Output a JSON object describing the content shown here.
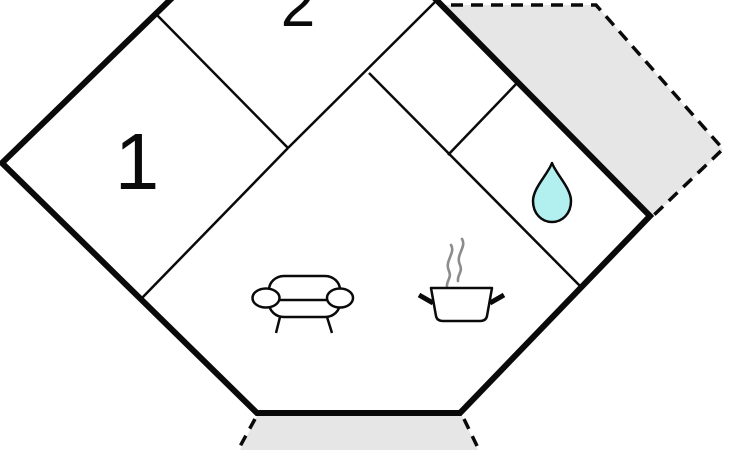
{
  "floorplan": {
    "title": "holiday-home-floor-plan",
    "room_labels": [
      {
        "id": "room-1",
        "text": "1"
      },
      {
        "id": "room-2",
        "text": "2"
      }
    ],
    "icons": [
      {
        "name": "sofa-icon"
      },
      {
        "name": "cooking-pot-icon"
      },
      {
        "name": "steam-icon"
      },
      {
        "name": "water-drop-icon"
      }
    ],
    "colors": {
      "wall": "#0a0a0a",
      "interior_wall": "#0a0a0a",
      "floor_fill": "#ffffff",
      "terrace_fill": "#e6e6e6",
      "terrace_dash": "#0a0a0a",
      "water_drop_fill": "#b2f0f0",
      "steam": "#8c8c8c"
    }
  }
}
